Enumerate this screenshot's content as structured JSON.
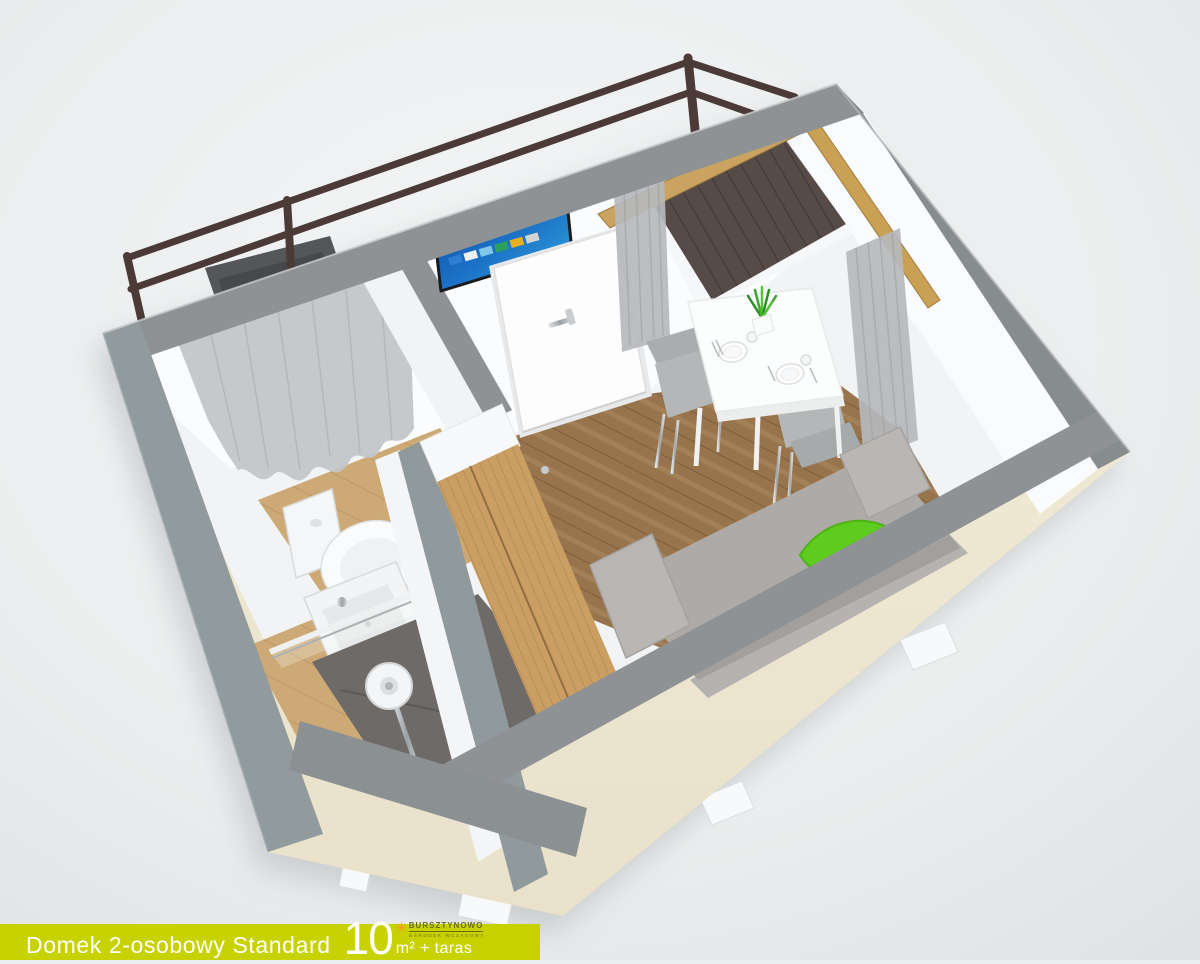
{
  "banner": {
    "title": "Domek 2-osobowy Standard",
    "area_value": "10",
    "area_unit": "m² + taras",
    "colors": {
      "background": "#c8d200",
      "text": "#ffffff"
    }
  },
  "logo": {
    "name": "BURSZTYNOWO",
    "tagline": "OŚRODEK WCZASOWY",
    "colors": {
      "sun": "#f59f1e",
      "text": "#6b6b10"
    }
  },
  "scene": {
    "type": "3d-cutaway-floorplan-render",
    "subject": "2-person standard cabin, 10 m² plus terrace",
    "rooms": [
      {
        "name": "main-room",
        "contents": [
          "sofa-bed",
          "green-blanket",
          "dining-table",
          "two-chairs",
          "plates",
          "plant",
          "wardrobe",
          "smart-tv",
          "entrance-door",
          "corner-window",
          "curtains",
          "wood-floor"
        ]
      },
      {
        "name": "bathroom",
        "contents": [
          "toilet",
          "washbasin",
          "shower",
          "glass-screen",
          "window-curtain",
          "tile-floor"
        ]
      },
      {
        "name": "terrace",
        "contents": [
          "railing",
          "deck",
          "chair"
        ]
      }
    ],
    "colors": {
      "background": "#ebedee",
      "wall_cap": "#8e9294",
      "exterior_wall": "#f0e9d5",
      "interior_wall": "#f7f8f9",
      "floor_wood": "#97744c",
      "bath_floor": "#cdaa75",
      "sofa": "#adaaa7",
      "blanket_green": "#5ecb1f",
      "tv_screen_blue": "#1c74c8",
      "window_frame_wood": "#c9a35f",
      "railing_brown": "#4b3a36",
      "deck_brown": "#574b48",
      "shower_tray": "#6e6a67"
    }
  }
}
